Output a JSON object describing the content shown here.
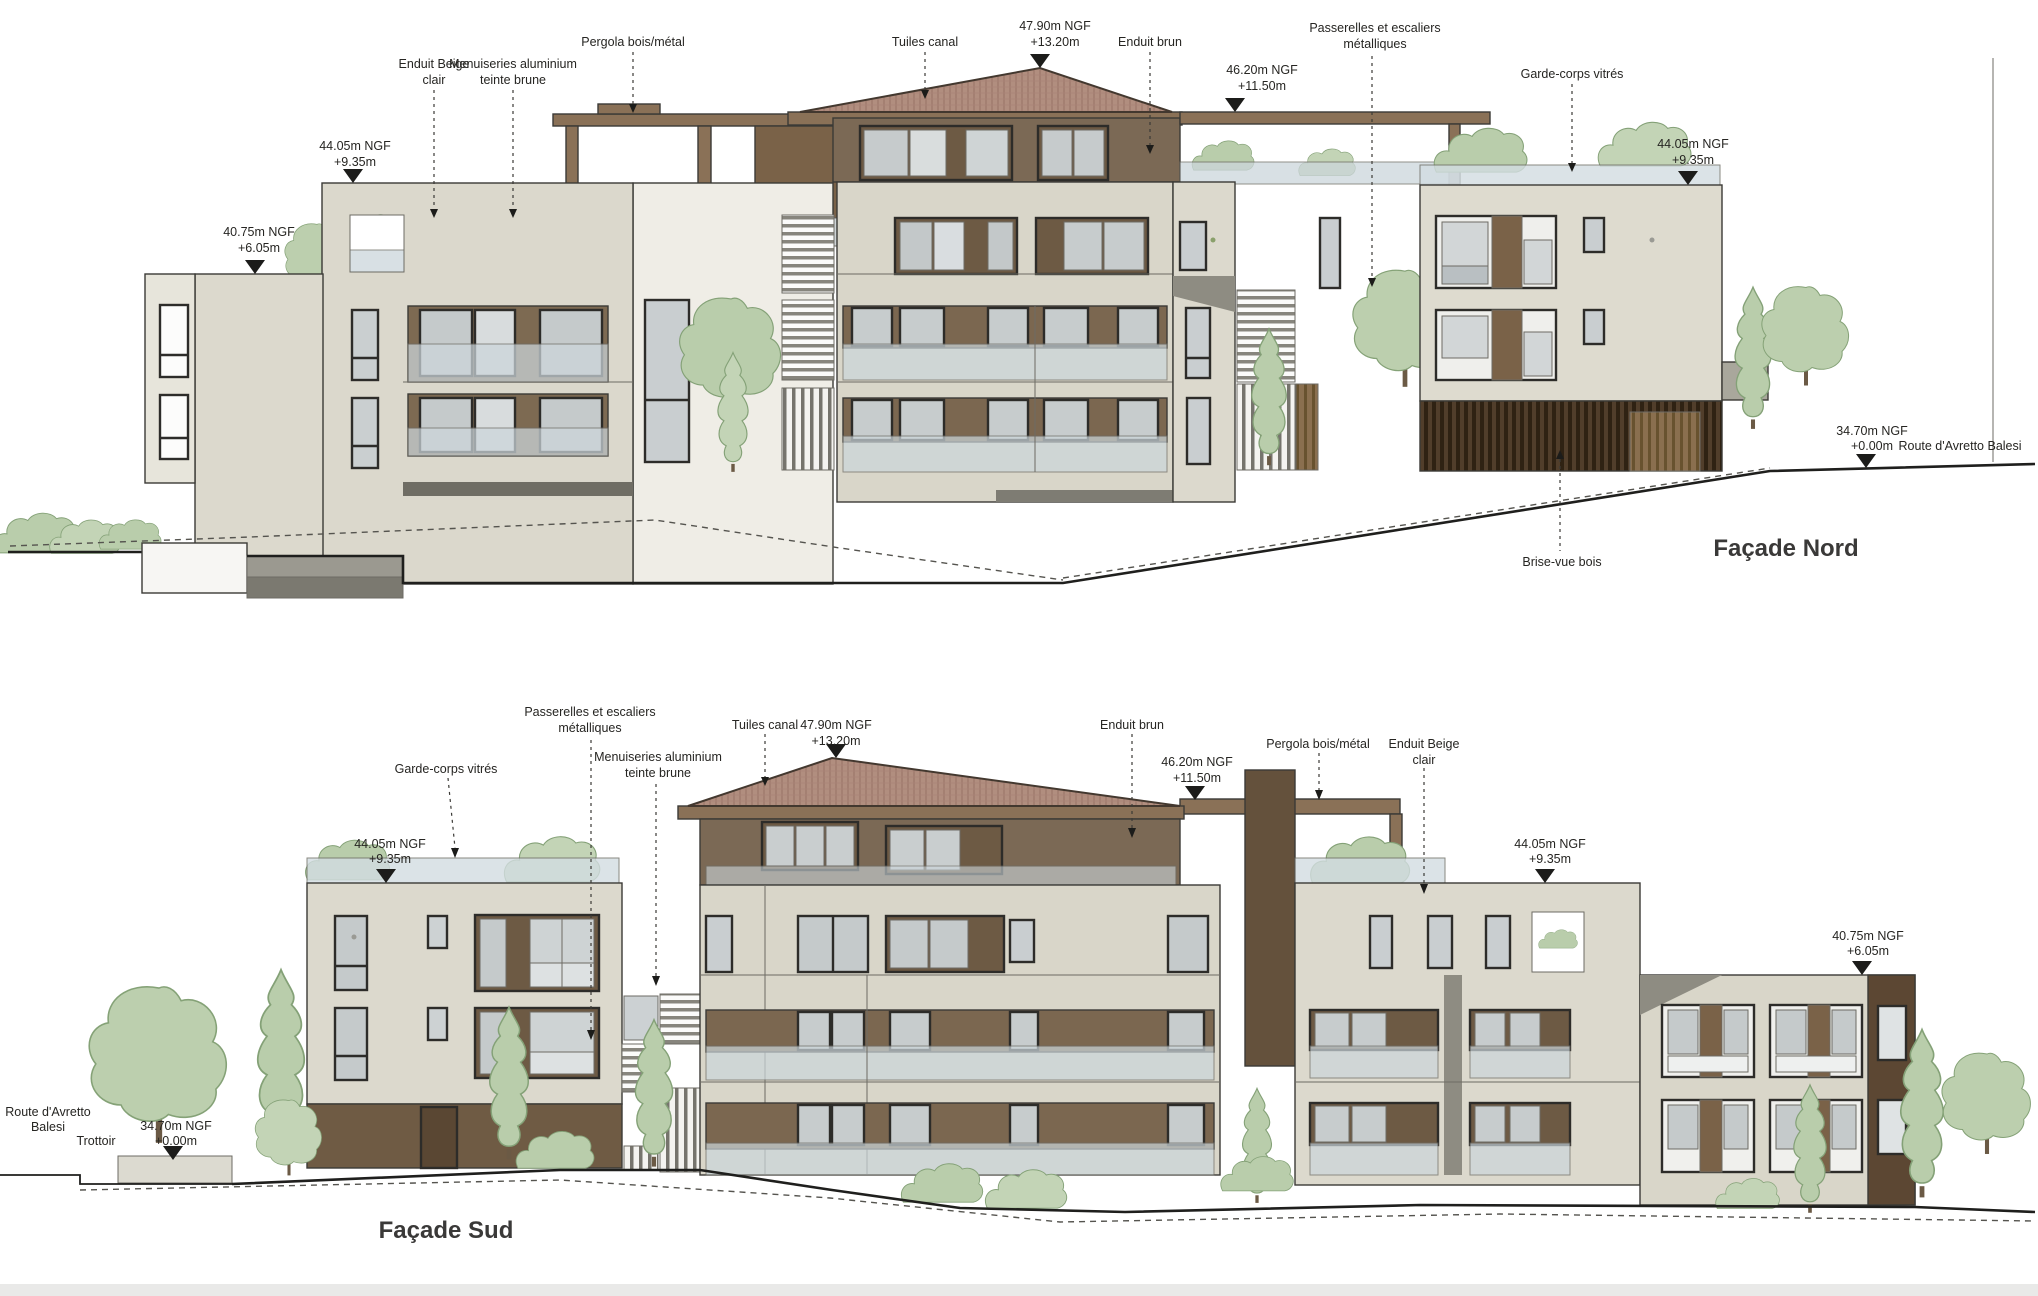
{
  "drawings": {
    "nord": {
      "title": "Façade Nord",
      "annotations": {
        "enduit_beige": {
          "l1": "Enduit Beige",
          "l2": "clair"
        },
        "menuiseries": {
          "l1": "Menuiseries aluminium",
          "l2": "teinte brune"
        },
        "pergola": {
          "l1": "Pergola bois/métal"
        },
        "tuiles": {
          "l1": "Tuiles canal"
        },
        "ridge_level": {
          "l1": "47.90m NGF",
          "l2": "+13.20m"
        },
        "enduit_brun": {
          "l1": "Enduit brun"
        },
        "level_4620": {
          "l1": "46.20m NGF",
          "l2": "+11.50m"
        },
        "passerelles": {
          "l1": "Passerelles et escaliers",
          "l2": "métalliques"
        },
        "garde_corps": {
          "l1": "Garde-corps vitrés"
        },
        "level_4405_left": {
          "l1": "44.05m NGF",
          "l2": "+9.35m"
        },
        "level_4405_right": {
          "l1": "44.05m NGF",
          "l2": "+9.35m"
        },
        "level_4075": {
          "l1": "40.75m NGF",
          "l2": "+6.05m"
        },
        "level_3470": {
          "l1": "34.70m NGF",
          "l2": "+0.00m"
        },
        "route": {
          "l1": "Route d'Avretto Balesi"
        },
        "brise_vue": {
          "l1": "Brise-vue bois"
        }
      }
    },
    "sud": {
      "title": "Façade Sud",
      "annotations": {
        "garde_corps": {
          "l1": "Garde-corps vitrés"
        },
        "passerelles": {
          "l1": "Passerelles et escaliers",
          "l2": "métalliques"
        },
        "menuiseries": {
          "l1": "Menuiseries aluminium",
          "l2": "teinte brune"
        },
        "tuiles": {
          "l1": "Tuiles canal"
        },
        "ridge_level": {
          "l1": "47.90m NGF",
          "l2": "+13.20m"
        },
        "enduit_brun": {
          "l1": "Enduit brun"
        },
        "level_4620": {
          "l1": "46.20m NGF",
          "l2": "+11.50m"
        },
        "pergola": {
          "l1": "Pergola bois/métal"
        },
        "enduit_beige": {
          "l1": "Enduit Beige",
          "l2": "clair"
        },
        "level_4405_left": {
          "l1": "44.05m NGF",
          "l2": "+9.35m"
        },
        "level_4405_right": {
          "l1": "44.05m NGF",
          "l2": "+9.35m"
        },
        "level_4075": {
          "l1": "40.75m NGF",
          "l2": "+6.05m"
        },
        "level_3470": {
          "l1": "34.70m NGF",
          "l2": "+0.00m"
        },
        "route": {
          "l1": "Route d'Avretto",
          "l2": "Balesi"
        },
        "trottoir": {
          "l1": "Trottoir"
        }
      }
    }
  },
  "colors": {
    "background": "#ffffff",
    "wall_beige": "#dcd9cd",
    "wall_beige_dark": "#d9d6c9",
    "enduit_brun": "#7b6955",
    "dark_wood": "#5c4733",
    "roof_tile": "#b18e7f",
    "glass_balustrade": "#ccd6db",
    "window_glass": "#c5cacb",
    "vegetation": "#b9cdab",
    "line": "#3b3a36"
  }
}
